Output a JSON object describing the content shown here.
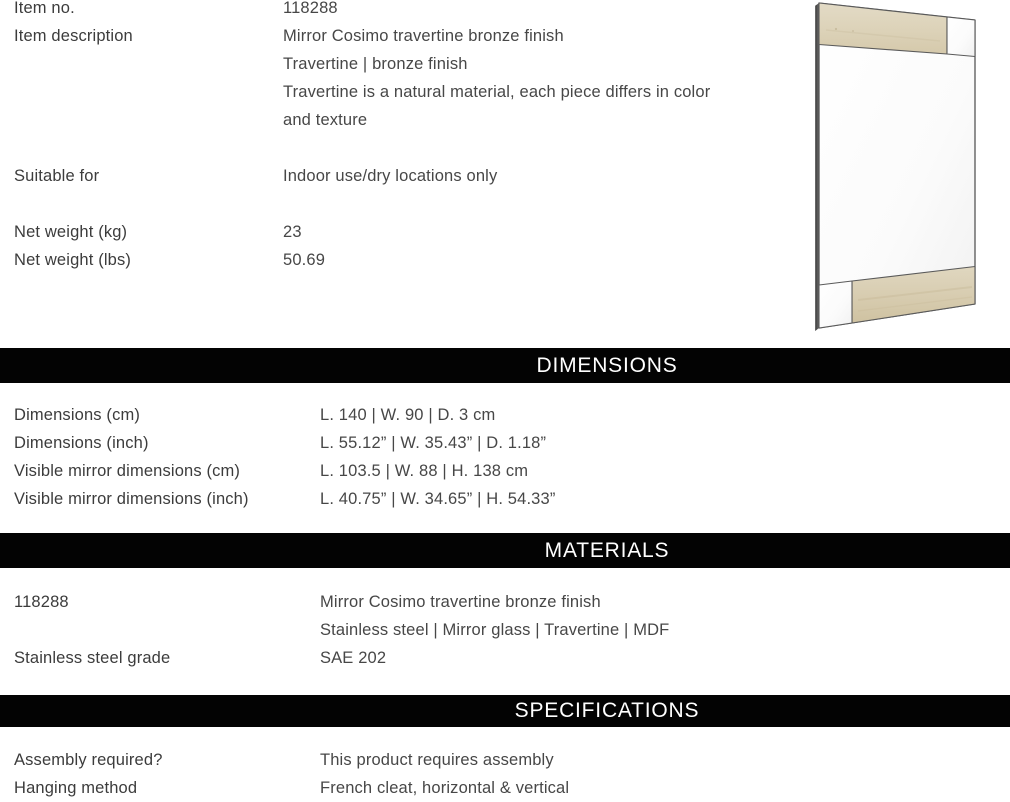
{
  "document": {
    "kind": "product-specification-sheet",
    "text_color": "#414141",
    "banner_bg": "#030303",
    "banner_fg": "#ffffff"
  },
  "info": {
    "rows": [
      {
        "label": "Item no.",
        "value": "118288"
      },
      {
        "label": "Item description",
        "value": "Mirror Cosimo travertine bronze finish"
      },
      {
        "label": "",
        "value": "Travertine | bronze finish"
      },
      {
        "label": "",
        "value": "Travertine is a natural material, each piece differs in color"
      },
      {
        "label": "",
        "value": "and texture"
      },
      {
        "label": "Suitable for",
        "value": "Indoor use/dry locations only"
      },
      {
        "label": "Net weight (kg)",
        "value": "23"
      },
      {
        "label": "Net weight (lbs)",
        "value": "50.69"
      }
    ]
  },
  "dimensions": {
    "heading": "DIMENSIONS",
    "rows": [
      {
        "label": "Dimensions (cm)",
        "value": "L. 140 | W. 90 | D. 3 cm"
      },
      {
        "label": "Dimensions (inch)",
        "value": "L. 55.12” | W. 35.43” | D. 1.18”"
      },
      {
        "label": "Visible mirror dimensions (cm)",
        "value": "L. 103.5 | W. 88 | H. 138 cm"
      },
      {
        "label": "Visible mirror dimensions (inch)",
        "value": "L. 40.75” | W. 34.65” | H. 54.33”"
      }
    ]
  },
  "materials": {
    "heading": "MATERIALS",
    "rows": [
      {
        "label": "118288",
        "value": "Mirror Cosimo travertine bronze finish"
      },
      {
        "label": "",
        "value": "Stainless steel | Mirror glass | Travertine | MDF"
      },
      {
        "label": "Stainless steel grade",
        "value": "SAE 202"
      }
    ]
  },
  "specifications": {
    "heading": "SPECIFICATIONS",
    "rows": [
      {
        "label": "Assembly required?",
        "value": "This product requires assembly"
      },
      {
        "label": "Hanging method",
        "value": "French cleat, horizontal & vertical"
      }
    ]
  },
  "product_image": {
    "name": "mirror-cosimo-angled-product-photo",
    "frame_color": "#545454",
    "travertine_color": "#dcd2b8",
    "mirror_color": "#fcfcfc"
  }
}
